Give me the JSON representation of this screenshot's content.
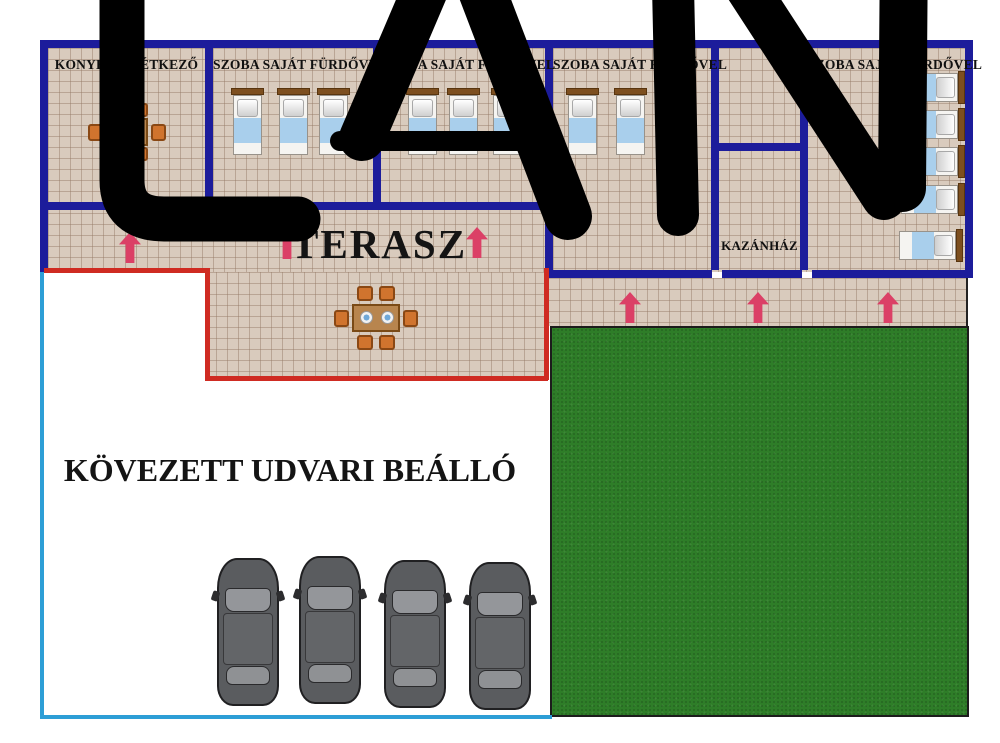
{
  "watermark": {
    "text": "LAN",
    "color": "#000000"
  },
  "colors": {
    "wall": "#1c1c9b",
    "tile": "#d9cbbd",
    "grass": "#2e7d28",
    "terrace_border": "#cf2b22",
    "parking_border": "#2d9ed6",
    "arrow": "#db4066",
    "bed_blanket": "#a9cfec",
    "furniture_wood": "#b8854e"
  },
  "building": {
    "rooms": [
      {
        "id": "konyha-etkezo",
        "label": "KONYHA ÉS ÉTKEZŐ",
        "furniture": "dining table with 4 chairs"
      },
      {
        "id": "szoba-1",
        "label": "SZOBA SAJÁT FÜRDŐVEL",
        "beds": 3
      },
      {
        "id": "szoba-2",
        "label": "SZOBA SAJÁT FÜRDŐVEL",
        "beds": 3
      },
      {
        "id": "szoba-3",
        "label": "SZOBA SAJÁT FÜRDŐVEL",
        "beds": 3
      },
      {
        "id": "kazanhaz",
        "label": "KAZÁNHÁZ"
      },
      {
        "id": "szoba-4",
        "label": "SZOBA SAJÁT FÜRDŐVEL",
        "beds": 5
      }
    ],
    "terrace": {
      "label": "TERASZ",
      "furniture": "dining table with 6 chairs",
      "entrance_arrows": 3
    },
    "walkway": {
      "entrance_arrows": 3
    },
    "parking": {
      "label": "KÖVEZETT UDVARI BEÁLLÓ",
      "cars": 4
    }
  }
}
